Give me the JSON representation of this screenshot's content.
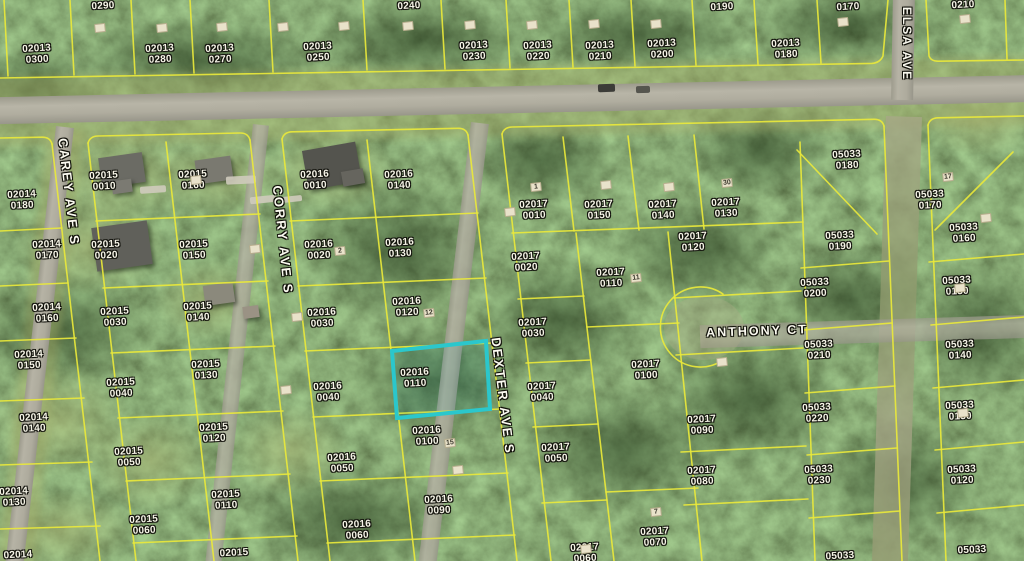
{
  "map": {
    "type": "aerial-parcel-map",
    "colors": {
      "parcel_line": "#e9e83b",
      "highlight": "#2bc7cc",
      "label_text": "#f7f5e8"
    },
    "highlight": {
      "parcel_id": "02016 0110"
    },
    "street_labels": [
      {
        "name": "carey-ave-s",
        "text": "CAREY AVE S",
        "x": 69,
        "y": 192,
        "rotate": 83.4,
        "size": 13
      },
      {
        "name": "corry-ave-s",
        "text": "CORRY AVE S",
        "x": 283,
        "y": 240,
        "rotate": 84,
        "size": 13
      },
      {
        "name": "dexter-ave-s",
        "text": "DEXTER AVE S",
        "x": 503,
        "y": 396,
        "rotate": 83,
        "size": 13
      },
      {
        "name": "elsa-ave-s",
        "text": "ELSA AVE",
        "x": 907,
        "y": 44,
        "rotate": 90,
        "size": 12
      },
      {
        "name": "anthony-ct",
        "text": "ANTHONY CT",
        "x": 757,
        "y": 331,
        "rotate": -2,
        "size": 12.5
      }
    ],
    "parcel_labels": [
      {
        "text": "02013 0300",
        "x": 37,
        "y": 55
      },
      {
        "text": "0290",
        "x": 103,
        "y": 7
      },
      {
        "text": "02013 0280",
        "x": 160,
        "y": 55
      },
      {
        "text": "02013 0270",
        "x": 220,
        "y": 55
      },
      {
        "text": "02013 0250",
        "x": 318,
        "y": 53
      },
      {
        "text": "0240",
        "x": 409,
        "y": 7
      },
      {
        "text": "02013 0230",
        "x": 474,
        "y": 52
      },
      {
        "text": "02013 0220",
        "x": 538,
        "y": 52
      },
      {
        "text": "02013 0210",
        "x": 600,
        "y": 52
      },
      {
        "text": "02013 0200",
        "x": 662,
        "y": 50
      },
      {
        "text": "0190",
        "x": 722,
        "y": 8
      },
      {
        "text": "02013 0180",
        "x": 786,
        "y": 50
      },
      {
        "text": "0170",
        "x": 848,
        "y": 8
      },
      {
        "text": "0210",
        "x": 963,
        "y": 6
      },
      {
        "text": "02014 0180",
        "x": 22,
        "y": 201
      },
      {
        "text": "02015 0010",
        "x": 104,
        "y": 182
      },
      {
        "text": "02015 0160",
        "x": 193,
        "y": 181
      },
      {
        "text": "02016 0010",
        "x": 315,
        "y": 181
      },
      {
        "text": "02016 0140",
        "x": 399,
        "y": 181
      },
      {
        "text": "02017 0010",
        "x": 534,
        "y": 211
      },
      {
        "text": "02017 0150",
        "x": 599,
        "y": 211
      },
      {
        "text": "02017 0140",
        "x": 663,
        "y": 211
      },
      {
        "text": "02017 0130",
        "x": 726,
        "y": 209
      },
      {
        "text": "05033 0180",
        "x": 847,
        "y": 161
      },
      {
        "text": "05033 0170",
        "x": 930,
        "y": 201
      },
      {
        "text": "05033 0190",
        "x": 840,
        "y": 242
      },
      {
        "text": "05033 0160",
        "x": 964,
        "y": 234
      },
      {
        "text": "02014 0170",
        "x": 47,
        "y": 251
      },
      {
        "text": "02015 0020",
        "x": 106,
        "y": 251
      },
      {
        "text": "02015 0150",
        "x": 194,
        "y": 251
      },
      {
        "text": "02016 0020",
        "x": 319,
        "y": 251
      },
      {
        "text": "02016 0130",
        "x": 400,
        "y": 249
      },
      {
        "text": "02017 0020",
        "x": 526,
        "y": 263
      },
      {
        "text": "02017 0120",
        "x": 693,
        "y": 243
      },
      {
        "text": "02017 0110",
        "x": 611,
        "y": 279
      },
      {
        "text": "02014 0160",
        "x": 47,
        "y": 314
      },
      {
        "text": "02015 0030",
        "x": 115,
        "y": 318
      },
      {
        "text": "02015 0140",
        "x": 198,
        "y": 313
      },
      {
        "text": "02016 0030",
        "x": 322,
        "y": 319
      },
      {
        "text": "02016 0120",
        "x": 407,
        "y": 308
      },
      {
        "text": "02017 0030",
        "x": 533,
        "y": 329
      },
      {
        "text": "05033 0200",
        "x": 815,
        "y": 289
      },
      {
        "text": "05033 0150",
        "x": 957,
        "y": 287
      },
      {
        "text": "02014 0150",
        "x": 29,
        "y": 361
      },
      {
        "text": "02015 0040",
        "x": 121,
        "y": 389
      },
      {
        "text": "02015 0130",
        "x": 206,
        "y": 371
      },
      {
        "text": "02016 0040",
        "x": 328,
        "y": 393
      },
      {
        "text": "02016 0110",
        "x": 415,
        "y": 379
      },
      {
        "text": "02017 0040",
        "x": 542,
        "y": 393
      },
      {
        "text": "02017 0100",
        "x": 646,
        "y": 371
      },
      {
        "text": "05033 0210",
        "x": 819,
        "y": 351
      },
      {
        "text": "05033 0140",
        "x": 960,
        "y": 351
      },
      {
        "text": "02014 0140",
        "x": 34,
        "y": 424
      },
      {
        "text": "02015 0120",
        "x": 214,
        "y": 434
      },
      {
        "text": "02016 0100",
        "x": 427,
        "y": 437
      },
      {
        "text": "02017 0090",
        "x": 702,
        "y": 426
      },
      {
        "text": "05033 0220",
        "x": 817,
        "y": 414
      },
      {
        "text": "05033 0130",
        "x": 960,
        "y": 412
      },
      {
        "text": "02015 0050",
        "x": 129,
        "y": 458
      },
      {
        "text": "02016 0050",
        "x": 342,
        "y": 464
      },
      {
        "text": "02017 0050",
        "x": 556,
        "y": 454
      },
      {
        "text": "02017 0080",
        "x": 702,
        "y": 477
      },
      {
        "text": "05033 0230",
        "x": 819,
        "y": 476
      },
      {
        "text": "05033 0120",
        "x": 962,
        "y": 476
      },
      {
        "text": "02014 0130",
        "x": 14,
        "y": 498
      },
      {
        "text": "02015 0110",
        "x": 226,
        "y": 501
      },
      {
        "text": "02015 0060",
        "x": 144,
        "y": 526
      },
      {
        "text": "02016 0090",
        "x": 439,
        "y": 506
      },
      {
        "text": "02016 0060",
        "x": 357,
        "y": 531
      },
      {
        "text": "02017 0070",
        "x": 655,
        "y": 538
      },
      {
        "text": "02014",
        "x": 18,
        "y": 556
      },
      {
        "text": "02015",
        "x": 234,
        "y": 554
      },
      {
        "text": "02017 0060",
        "x": 585,
        "y": 554
      },
      {
        "text": "05033",
        "x": 840,
        "y": 557
      },
      {
        "text": "05033",
        "x": 972,
        "y": 551
      }
    ],
    "lot_markers": [
      {
        "text": "1",
        "x": 536,
        "y": 187
      },
      {
        "text": "30",
        "x": 727,
        "y": 183
      },
      {
        "text": "17",
        "x": 948,
        "y": 177
      },
      {
        "text": "2",
        "x": 340,
        "y": 251
      },
      {
        "text": "11",
        "x": 636,
        "y": 278
      },
      {
        "text": "12",
        "x": 429,
        "y": 313
      },
      {
        "text": "15",
        "x": 450,
        "y": 443
      },
      {
        "text": "7",
        "x": 656,
        "y": 512
      }
    ],
    "blank_markers": [
      {
        "x": 100,
        "y": 28
      },
      {
        "x": 162,
        "y": 28
      },
      {
        "x": 222,
        "y": 27
      },
      {
        "x": 283,
        "y": 27
      },
      {
        "x": 344,
        "y": 26
      },
      {
        "x": 408,
        "y": 26
      },
      {
        "x": 470,
        "y": 25
      },
      {
        "x": 532,
        "y": 25
      },
      {
        "x": 594,
        "y": 24
      },
      {
        "x": 656,
        "y": 24
      },
      {
        "x": 843,
        "y": 22
      },
      {
        "x": 965,
        "y": 19
      },
      {
        "x": 196,
        "y": 180
      },
      {
        "x": 255,
        "y": 249
      },
      {
        "x": 297,
        "y": 317
      },
      {
        "x": 510,
        "y": 212
      },
      {
        "x": 606,
        "y": 185
      },
      {
        "x": 669,
        "y": 187
      },
      {
        "x": 960,
        "y": 288
      },
      {
        "x": 722,
        "y": 362
      },
      {
        "x": 286,
        "y": 390
      },
      {
        "x": 458,
        "y": 470
      },
      {
        "x": 986,
        "y": 218
      },
      {
        "x": 963,
        "y": 413
      },
      {
        "x": 586,
        "y": 549
      }
    ]
  }
}
